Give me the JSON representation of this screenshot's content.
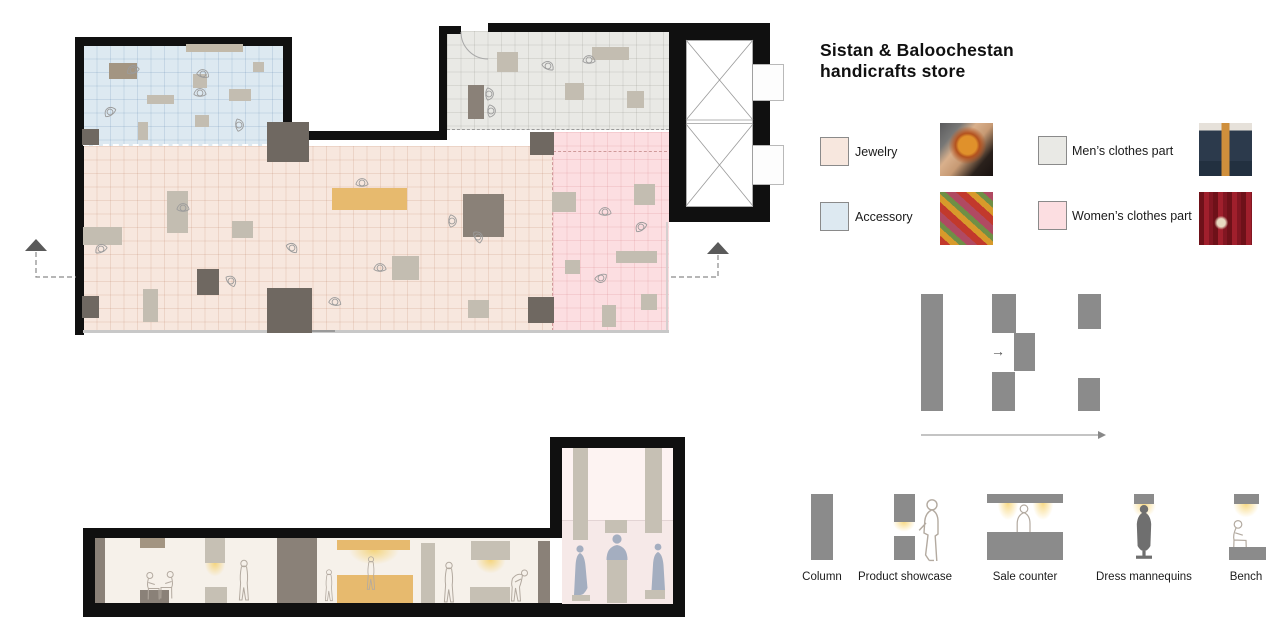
{
  "title": {
    "line1": "Sistan & Baloochestan",
    "line2": "handicrafts store"
  },
  "legend": {
    "items": [
      {
        "label": "Jewelry",
        "color": "#f7e7de"
      },
      {
        "label": "Accessory",
        "color": "#dde9f1"
      },
      {
        "label": "Men’s clothes part",
        "color": "#e9e9e5"
      },
      {
        "label": "Women’s clothes part",
        "color": "#fcdee1"
      }
    ]
  },
  "flow_diagram": {
    "arrow_glyph": "→"
  },
  "symbols": {
    "items": [
      {
        "label": "Column"
      },
      {
        "label": "Product showcase"
      },
      {
        "label": "Sale counter"
      },
      {
        "label": "Dress mannequins"
      },
      {
        "label": "Bench"
      }
    ]
  }
}
